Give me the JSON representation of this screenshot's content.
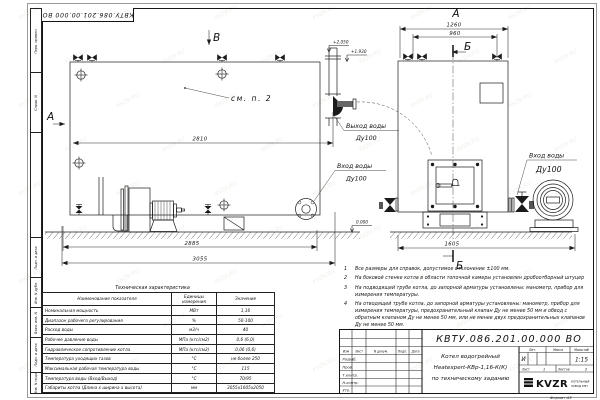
{
  "frame": {
    "stamp": "КВТУ.086.201.00.000  ВО",
    "format_note": "Формат  А3",
    "margin_labels": [
      "Перв. примен.",
      "Справ. N",
      "Подп. и дата",
      "Инв. N дубл.",
      "Взам. инв. N",
      "Подп. и дата",
      "Инв. N подл."
    ]
  },
  "views": {
    "b_label": "В",
    "a_arrow_label": "А",
    "a_view_label": "А",
    "section_top": "Б",
    "section_bottom": "Б",
    "see_note": "см. п. 2"
  },
  "elevations": {
    "outlet": "+2.050",
    "roof": "+1.930",
    "ground": "0.000"
  },
  "dims": {
    "d2810": "2810",
    "d2885": "2885",
    "d3055": "3055",
    "d1260": "1260",
    "d960": "960",
    "d1605": "1605"
  },
  "pipes": {
    "outlet_title": "Выход воды",
    "outlet_dn": "Ду100",
    "inlet_title": "Вход воды",
    "inlet_dn": "Ду100",
    "inlet_front_title": "Вход воды",
    "inlet_front_dn": "Ду100"
  },
  "notes": {
    "items": [
      {
        "num": "1",
        "text": "Все размеры для справок, допустимое отклонение ±100 мм."
      },
      {
        "num": "2",
        "text": "На боковой стенке котла в области топочной камеры установлен дробоотборный штуцер"
      },
      {
        "num": "3",
        "text": "На  подводящей трубе котла, до запорной арматуры установлены:  манометр, прибор для измерения температуры."
      },
      {
        "num": "4",
        "text": "На отводящей трубе котла, до запорной арматуры установлены: манометр, прибор для измерения температуры, предохранительный клапан Ду не менее 50 мм и обвод с обратным клапаном Ду не менее 50 мм, или не менее двух предохранительных клапанов Ду не менее 50 мм."
      }
    ]
  },
  "spec_table": {
    "title": "Техническая характеристика",
    "headers": {
      "name": "Наименование показателя",
      "units": "Единицы измерения",
      "value": "Значение"
    },
    "rows": [
      {
        "name": "Номинальная мощность",
        "units": "МВт",
        "value": "1,16"
      },
      {
        "name": "Диапазон рабочего регулирования",
        "units": "%",
        "value": "50-100"
      },
      {
        "name": "Расход воды",
        "units": "м3/ч",
        "value": "40"
      },
      {
        "name": "Рабочее давление воды",
        "units": "МПа (кгс/см2)",
        "value": "0,6 (6,0)"
      },
      {
        "name": "Гидравлическое сопротивление котла",
        "units": "МПа (кгс/см2)",
        "value": "0,06 (0,6)"
      },
      {
        "name": "Температура уходящих газов",
        "units": "°С",
        "value": "не более 250"
      },
      {
        "name": "Максимальная рабочая температура воды",
        "units": "°С",
        "value": "115"
      },
      {
        "name": "Температура воды (Вход/Выход)",
        "units": "°С",
        "value": "70/95"
      },
      {
        "name": "Габариты котла (Длина х ширина х высота)",
        "units": "мм",
        "value": "3055х1605х2050"
      }
    ]
  },
  "title_block": {
    "doc_number": "КВТУ.086.201.00.000  ВО",
    "name_line1": "Котел водогрейный",
    "name_line2": "Heatexpert-КВр-1,16-К(К)",
    "name_line3": "по техническому заданию",
    "cols": [
      "Изм",
      "Лист",
      "N докум.",
      "Подп.",
      "Дата"
    ],
    "rows": [
      "Разраб.",
      "Пров.",
      "Т.контр.",
      "Н.контр.",
      "Утв."
    ],
    "lit_label": "Лит.",
    "lit_value": "И",
    "mass_label": "Масса",
    "scale_label": "Масштаб",
    "scale_value": "1:15",
    "sheet_label": "Лист",
    "sheet_value": "1",
    "sheets_label": "Листов",
    "sheets_value": "2",
    "brand": "KVZR",
    "brand_line1": "КОТЕЛЬНЫЙ",
    "brand_line2": "ЗАВОД РЭП"
  },
  "watermark": {
    "text": "KVZR.RU"
  }
}
